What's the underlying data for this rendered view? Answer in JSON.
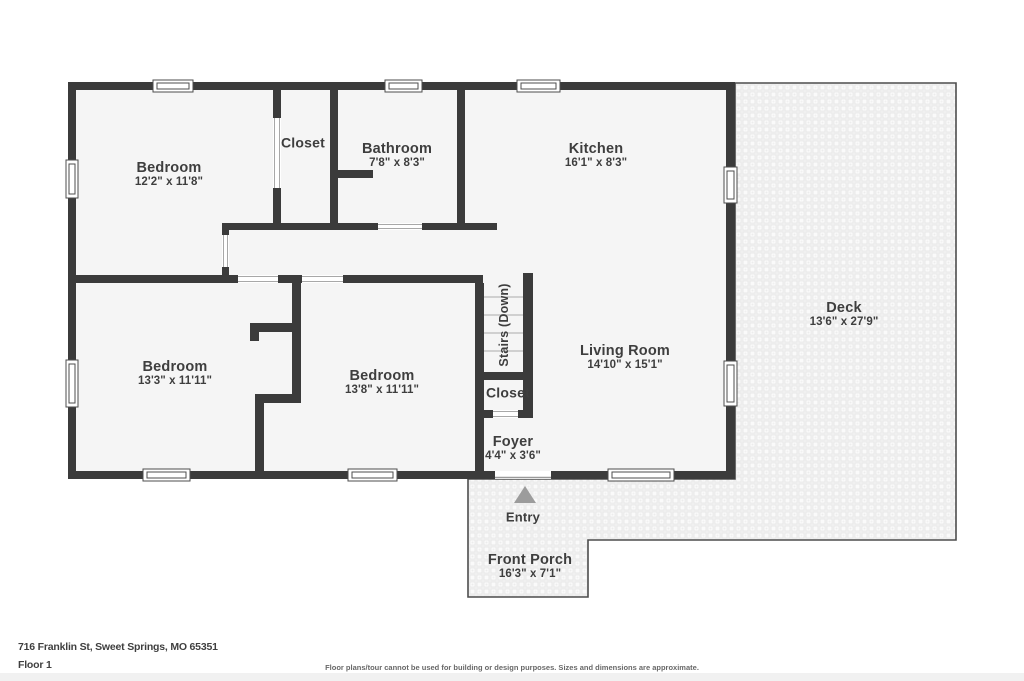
{
  "palette": {
    "wall": "#3b3b3b",
    "room_fill": "#f5f5f5",
    "label_text": "#3e3e3e",
    "outdoor_border": "#4d4d4d",
    "outdoor_pattern_base": "#f3f3f3",
    "outdoor_pattern_line": "#e4e4e4",
    "door_jamb": "#a8a8a8",
    "stair_step_line": "#c4c4c4",
    "entry_arrow": "#9c9c9c",
    "footer_text": "#3f3f3f",
    "disclaimer_text": "#686868",
    "bottom_bar": "#f1f1f1"
  },
  "icons": {
    "entry_arrow_icon": "up-triangle",
    "window_icon": "double-line-window",
    "door_opening_icon": "cased-opening"
  },
  "rooms": {
    "bedroom1": {
      "name": "Bedroom",
      "dims": "12'2\" x 11'8\""
    },
    "closet1": {
      "name": "Closet",
      "dims": ""
    },
    "bathroom": {
      "name": "Bathroom",
      "dims": "7'8\" x 8'3\""
    },
    "kitchen": {
      "name": "Kitchen",
      "dims": "16'1\" x 8'3\""
    },
    "living_room": {
      "name": "Living Room",
      "dims": "14'10\" x 15'1\""
    },
    "bedroom2": {
      "name": "Bedroom",
      "dims": "13'3\" x 11'11\""
    },
    "bedroom3": {
      "name": "Bedroom",
      "dims": "13'8\" x 11'11\""
    },
    "stairs": {
      "name": "Stairs (Down)",
      "dims": ""
    },
    "closet2": {
      "name": "Closet",
      "dims": ""
    },
    "foyer": {
      "name": "Foyer",
      "dims": "4'4\" x 3'6\""
    },
    "entry": {
      "name": "Entry",
      "dims": ""
    },
    "front_porch": {
      "name": "Front Porch",
      "dims": "16'3\" x 7'1\""
    },
    "deck": {
      "name": "Deck",
      "dims": "13'6\" x 27'9\""
    }
  },
  "footer": {
    "address": "716 Franklin St, Sweet Springs, MO 65351",
    "floor_label": "Floor 1",
    "disclaimer": "Floor plans/tour cannot be used for building or design purposes. Sizes and dimensions are approximate."
  }
}
